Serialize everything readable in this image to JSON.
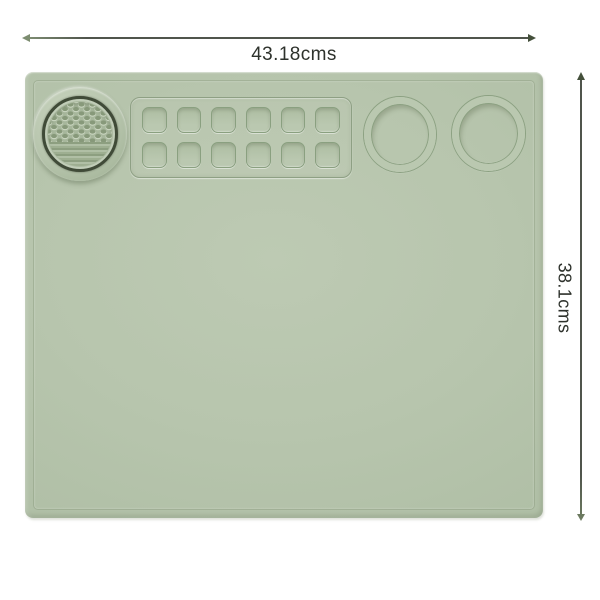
{
  "dimensions": {
    "width_label": "43.18cms",
    "height_label": "38.1cms"
  },
  "mat": {
    "base_color": "#b7c5ad",
    "paint_grid": {
      "rows": 2,
      "columns": 6
    },
    "cup_holders_count": 2
  },
  "annotation": {
    "line_color": "#50554c",
    "text_color": "#2e322c"
  }
}
